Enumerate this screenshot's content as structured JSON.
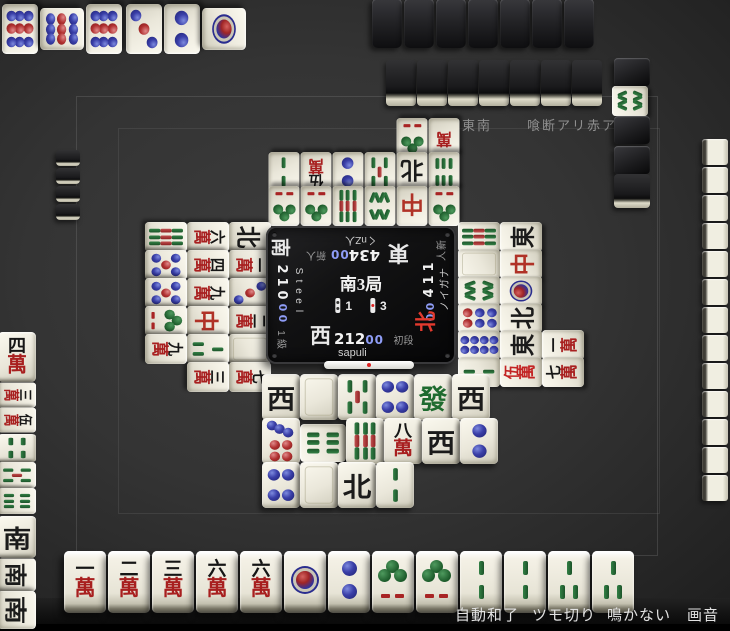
{
  "window": {
    "title": "Tenhou mahjong table",
    "width": 730,
    "height": 631
  },
  "rules": {
    "length": "東南",
    "options": "喰断アリ赤アリ"
  },
  "round": {
    "label": "南3局",
    "honba": "1",
    "deposits": "3"
  },
  "players": {
    "bottom": {
      "seat": "西",
      "name": "sapuli",
      "score_main": "212",
      "score_tail": "00",
      "rank": "初段",
      "active": false,
      "riichi": true
    },
    "right": {
      "seat": "北",
      "name": "ナガイノ",
      "score_main": "114",
      "score_tail": "00",
      "rank": "新人",
      "active": true
    },
    "top": {
      "seat": "東",
      "name": "くnZ人",
      "score_main": "434",
      "score_tail": "00",
      "rank": "新人",
      "active": false
    },
    "left": {
      "seat": "南",
      "name": "Steel",
      "score_main": "210",
      "score_tail": "00",
      "rank": "1級",
      "active": false
    }
  },
  "dora_indicator": "8s",
  "hands": {
    "bottom": [
      "1m",
      "2m",
      "3m",
      "6m",
      "6m",
      "1p",
      "2p",
      "1s",
      "1s",
      "2s",
      "2s",
      "3s",
      "3s"
    ],
    "top_hidden_count": 7,
    "right_hidden_count": 13,
    "left_hidden_count": 4,
    "top_wall_count": 7
  },
  "dead_wall_column": [
    "back",
    "8s",
    "back",
    "back",
    "back"
  ],
  "discards": {
    "bottom": [
      [
        "W",
        "P",
        "5s",
        "4p",
        "F",
        "W"
      ],
      [
        "7p",
        "6s",
        "9s",
        "8m",
        "W",
        "2p"
      ],
      [
        "4p",
        "P",
        "N",
        "2s"
      ]
    ],
    "bottom_riichi_pos": {
      "row": 1,
      "col": 1
    },
    "right": [
      [
        "9s",
        "P",
        "8s",
        "6p",
        "8p",
        "2s"
      ],
      [
        "E",
        "C",
        "1p",
        "N",
        "E",
        "0m"
      ],
      [
        "1m",
        "7m"
      ]
    ],
    "right_row3_offset": 4,
    "top": [
      [
        "1s",
        "1s",
        "9s",
        "8s",
        "C",
        "1s"
      ],
      [
        "2s",
        "5m",
        "2p",
        "5s",
        "N",
        "6s"
      ],
      [
        "1s",
        "xm"
      ]
    ],
    "top_row3_offset": 4,
    "left": [
      [
        "N",
        "1m",
        "3p",
        "2m",
        "P",
        "7m"
      ],
      [
        "6m",
        "4m",
        "9m",
        "C",
        "3s",
        "3m"
      ],
      [
        "9s",
        "5p",
        "5p",
        "1s",
        "9m"
      ]
    ]
  },
  "melds": {
    "top": [
      {
        "tiles": [
          "9p",
          "9p",
          "9p"
        ],
        "rotated": 1
      },
      {
        "tiles": [
          "3p",
          "2p",
          "1p"
        ],
        "rotated": 2
      }
    ],
    "left": [
      {
        "tiles": [
          "4m",
          "3m",
          "5m"
        ],
        "rotated": 0
      },
      {
        "tiles": [
          "4s",
          "5s",
          "6s"
        ],
        "rotated": 0
      },
      {
        "tiles": [
          "S",
          "S",
          "S"
        ],
        "rotated": 0
      }
    ]
  },
  "menu": {
    "items": [
      "自動和了",
      "ツモ切り",
      "鳴かない",
      "画音"
    ]
  },
  "colors": {
    "active_wind": "#e33a2e",
    "score_tail": "#8e9cf5",
    "tile_red": "#a81f1f",
    "tile_green": "#1f6b2f",
    "tile_blue": "#2b2f9e"
  }
}
